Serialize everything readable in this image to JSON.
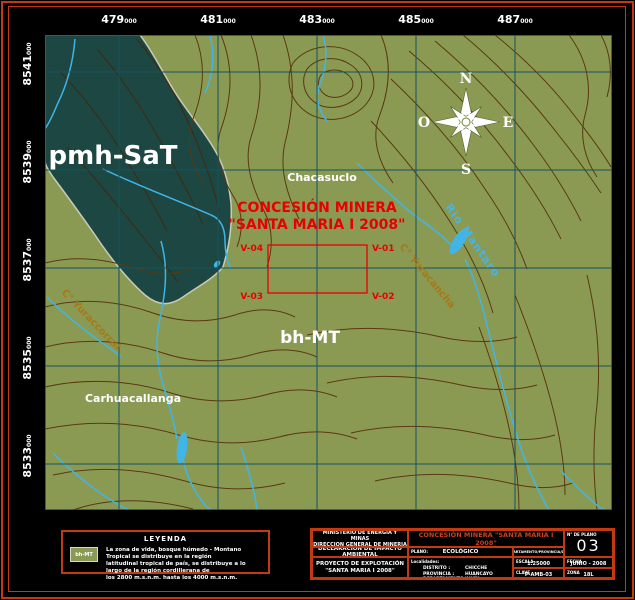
{
  "colors": {
    "frame_red": "#c23a12",
    "map_green": "#8b9a52",
    "zone_teal": "#1d4742",
    "contour_brown": "#5a3814",
    "river_blue": "#41b5e8",
    "grid_teal": "#145360",
    "concession_red": "#e80000",
    "hill_ochre": "#a87818"
  },
  "map": {
    "top_coords": [
      {
        "main": "479",
        "sub": "000"
      },
      {
        "main": "481",
        "sub": "000"
      },
      {
        "main": "483",
        "sub": "000"
      },
      {
        "main": "485",
        "sub": "000"
      },
      {
        "main": "487",
        "sub": "000"
      }
    ],
    "left_coords": [
      {
        "main": "8541",
        "sub": "000"
      },
      {
        "main": "8539",
        "sub": "000"
      },
      {
        "main": "8537",
        "sub": "000"
      },
      {
        "main": "8535",
        "sub": "000"
      },
      {
        "main": "8533",
        "sub": "000"
      }
    ],
    "zones": {
      "dark": "pmh-SaT",
      "green": "bh-MT"
    },
    "places": {
      "village_top": "Chacasuclo",
      "village_bottom": "Carhuacallanga"
    },
    "hills": {
      "left": "C° Yuraccorral",
      "right": "C° Yuracancha"
    },
    "river_name": "Rio Mantaro",
    "compass": {
      "n": "N",
      "s": "S",
      "e": "E",
      "w": "O"
    },
    "concession": {
      "line1": "CONCESIÓN MINERA",
      "line2": "\"SANTA MARIA I 2008\"",
      "v1": "V-01",
      "v2": "V-02",
      "v3": "V-03",
      "v4": "V-04"
    }
  },
  "legend": {
    "title": "LEYENDA",
    "swatch": "bh-MT",
    "lines": [
      "La zona de vida, bosque húmedo - Montano Tropical se distribuye en la región",
      "latitudinal tropical de país, se distribuye a lo largo de la región cordillerana de",
      "los 2800 m.s.n.m. hasta los 4000 m.s.n.m."
    ]
  },
  "titleblock": {
    "ministry_line1": "MINISTERIO DE ENERGIA Y MINAS",
    "ministry_line2": "DIRECCION GENERAL DE MINERIA",
    "doc_type": "DECLARACIÓN DE IMPACTO AMBIENTAL",
    "project_line1": "PROYECTO DE EXPLOTACIÓN",
    "project_line2": "\"SANTA MARIA I 2008\"",
    "main_title": "CONCESIÓN MINERA \"SANTA MARIA I 2008\"",
    "plano_label": "PLANO:",
    "plano_value": "ECOLÓGICO",
    "header_cell": "DEPARTAMENTO/PROVINCIA/DIST.",
    "sheet_label": "N° DE PLANO",
    "sheet_number": "03",
    "escala_label": "ESCALA",
    "escala_value": "1:25000",
    "fecha_label": "FECHA",
    "fecha_value": "JUNIO - 2008",
    "clave_label": "CLAVE",
    "clave_value": "P-AMB-03",
    "zona_label": "ZONA",
    "zona_value": "18L",
    "localidades_label": "Localidades:",
    "loc_rows": {
      "r1": {
        "label": "DISTRITO :",
        "value": "CHICCHE"
      },
      "r2": {
        "label": "PROVINCIA :",
        "value": "HUANCAYO"
      },
      "r3": {
        "label": "DEPARTAMENTO :",
        "value": "JUNÍN"
      }
    }
  }
}
